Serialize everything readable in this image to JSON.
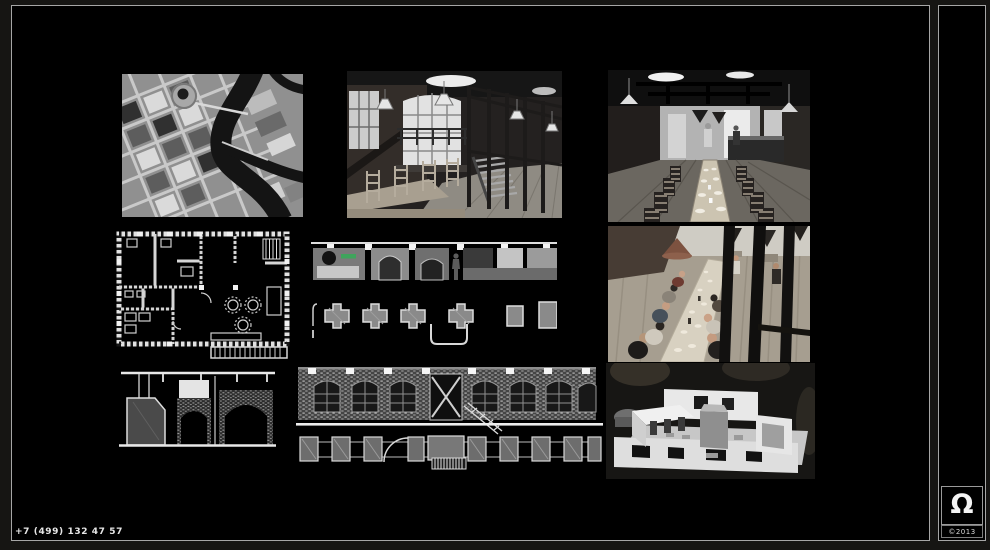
{
  "colors": {
    "page_background": "#161513",
    "canvas_background": "#000000",
    "frame_border": "#a6a6a6",
    "text": "#e6e6e6",
    "drawing_accent_green": "#3fa45c"
  },
  "footer": {
    "phone": "+7 (499) 132 47 57"
  },
  "brand": {
    "glyph": "Ω",
    "copyright": "©2013"
  },
  "gallery": {
    "tiles": [
      {
        "label": "Aerial satellite map of the site with river"
      },
      {
        "label": "Interior photo: brick hall with steel staircase and wooden chairs"
      },
      {
        "label": "Interior photo: dining hall with long table and pendant lamps"
      },
      {
        "label": "CAD floor plan drawing"
      },
      {
        "label": "Interior elevation and furniture plan drawing"
      },
      {
        "label": "Interior photo: guests dining at long table seen through railing"
      },
      {
        "label": "Brick vault section drawing"
      },
      {
        "label": "Brick facade elevation with plan strip drawing"
      },
      {
        "label": "Photo of white architectural scale model"
      }
    ]
  }
}
